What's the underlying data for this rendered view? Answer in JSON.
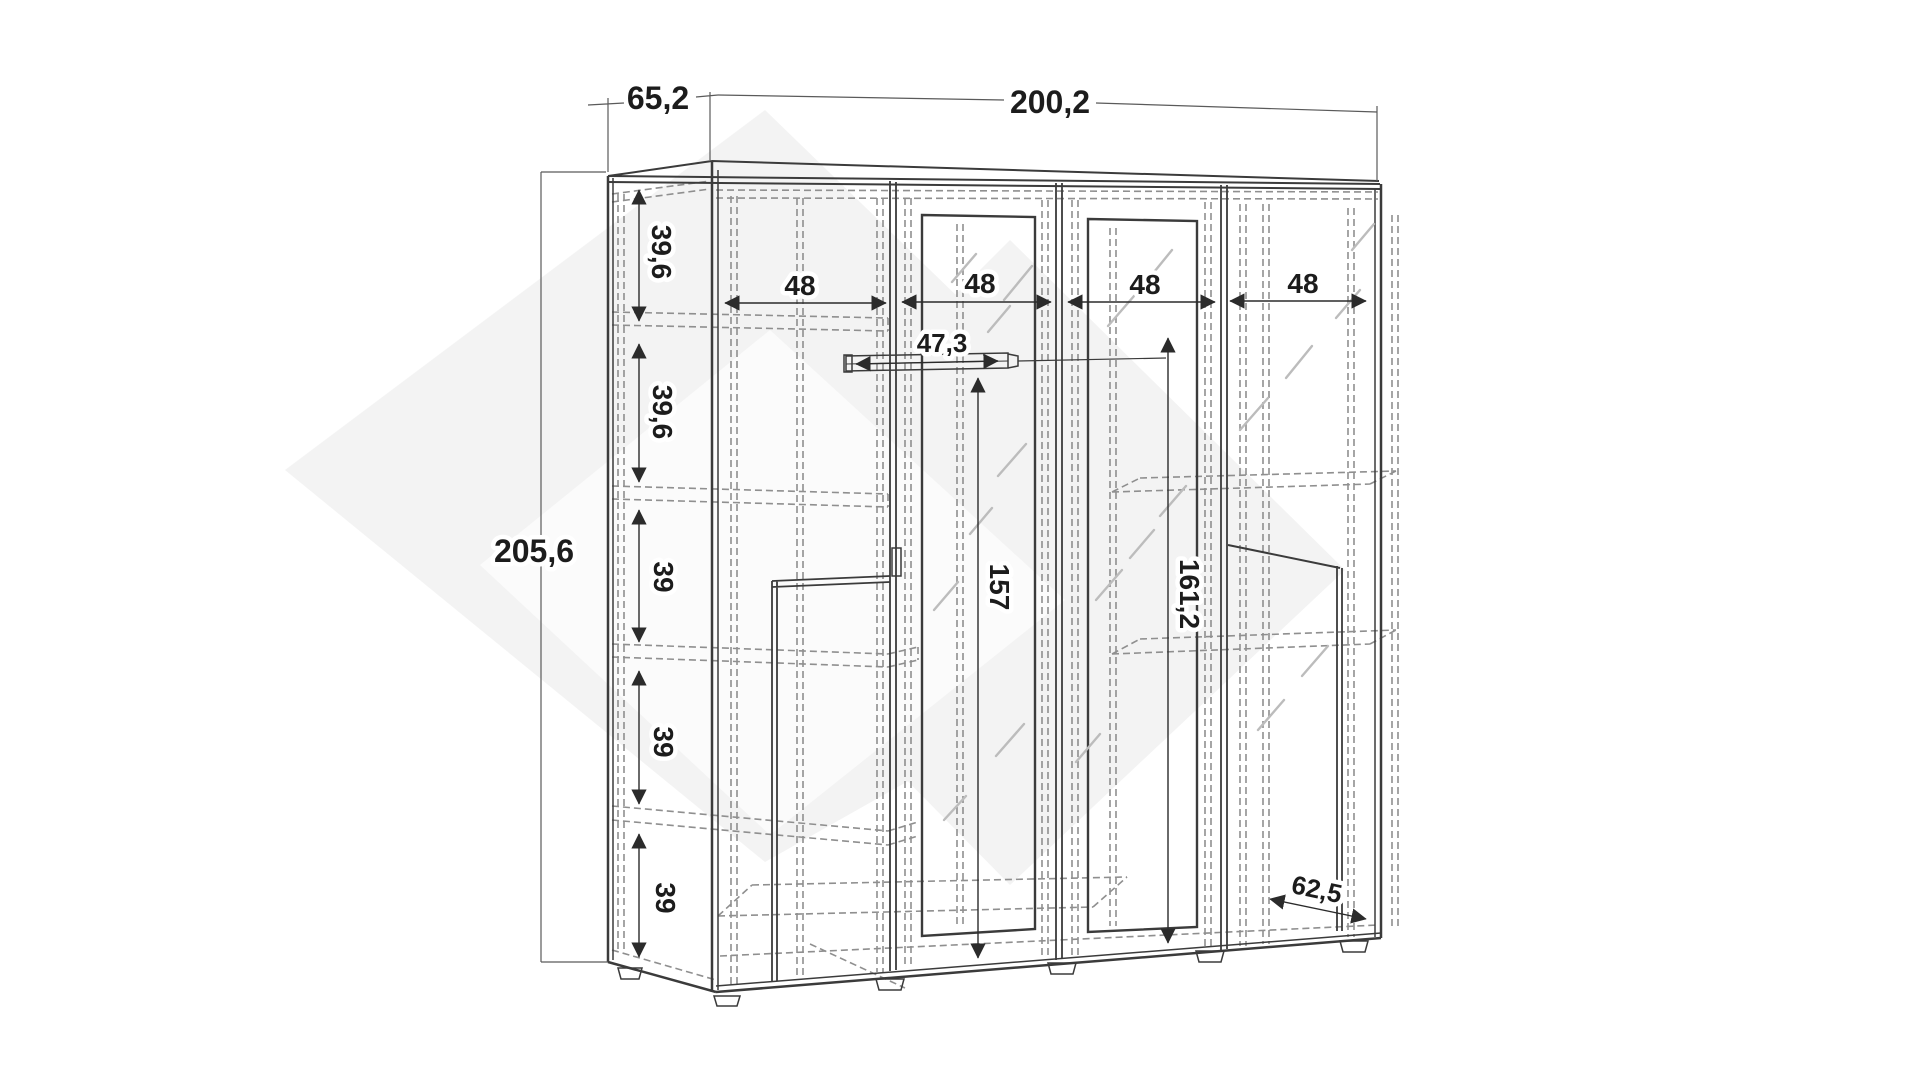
{
  "diagram": {
    "type": "furniture-dimension-drawing",
    "item": "four-door wardrobe technical drawing",
    "colors": {
      "background": "#ffffff",
      "solid_line": "#3b3b3b",
      "hidden_line": "#8f8f8f",
      "mirror_hatch": "#bcbcbc",
      "dimension_text": "#1c1c1c",
      "watermark": "#f3f3f3"
    },
    "dimensions": {
      "top_depth": "65,2",
      "total_width": "200,2",
      "total_height": "205,6",
      "left_sections": [
        "39,6",
        "39,6",
        "39",
        "39",
        "39"
      ],
      "compartments": [
        "48",
        "48",
        "48",
        "48"
      ],
      "rod_length": "47,3",
      "rod_height": "157",
      "interior_height": "161,2",
      "base_depth": "62,5"
    }
  }
}
